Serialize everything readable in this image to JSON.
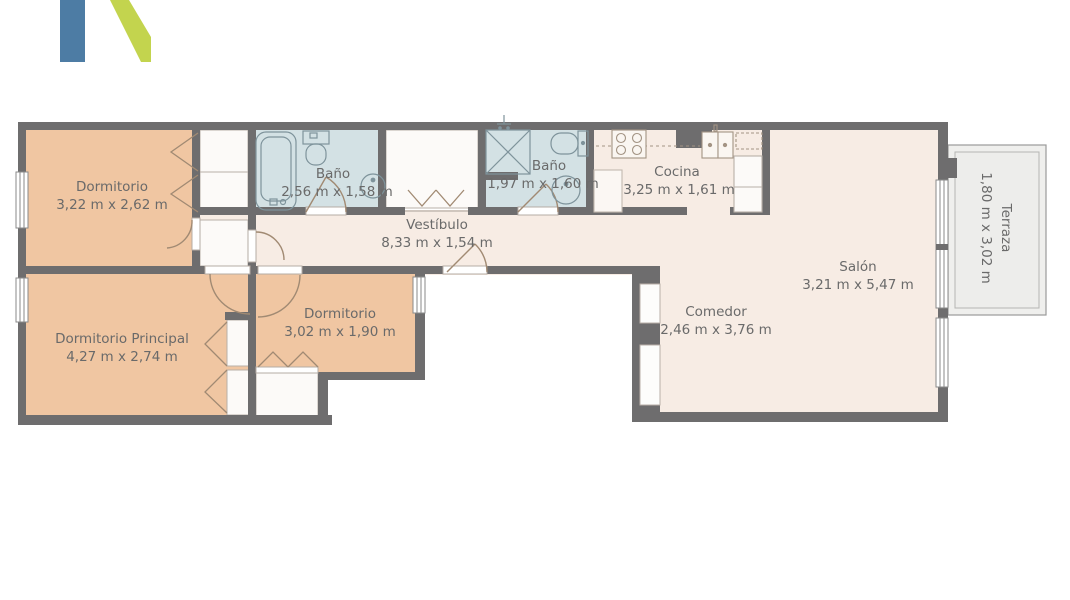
{
  "logo": {
    "blue": "#4d7ca4",
    "green": "#c3d44e"
  },
  "palette": {
    "wall": "#6e6d6e",
    "bedroom_floor": "#f0c6a2",
    "bathroom_floor": "#d3e1e4",
    "living_floor": "#f7ece4",
    "closet_fill": "#fcfaf8",
    "terrace_floor": "#efefed",
    "label_text": "#6a6a6a",
    "background": "#ffffff"
  },
  "floorplan": {
    "rooms": {
      "dormitorio1": {
        "name": "Dormitorio",
        "dims": "3,22 m x 2,62 m"
      },
      "bano1": {
        "name": "Baño",
        "dims": "2,56 m x 1,58 m"
      },
      "vestibulo": {
        "name": "Vestíbulo",
        "dims": "8,33 m x 1,54 m"
      },
      "bano2": {
        "name": "Baño",
        "dims": "1,97 m x 1,60 m"
      },
      "cocina": {
        "name": "Cocina",
        "dims": "3,25 m x 1,61 m"
      },
      "salon": {
        "name": "Salón",
        "dims": "3,21 m x 5,47 m"
      },
      "comedor": {
        "name": "Comedor",
        "dims": "2,46 m x 3,76 m"
      },
      "dormitorio_principal": {
        "name": "Dormitorio Principal",
        "dims": "4,27 m x 2,74 m"
      },
      "dormitorio2": {
        "name": "Dormitorio",
        "dims": "3,02 m x 1,90 m"
      },
      "terraza": {
        "name": "Terraza",
        "dims": "1,80 m x 3,02 m"
      }
    }
  }
}
